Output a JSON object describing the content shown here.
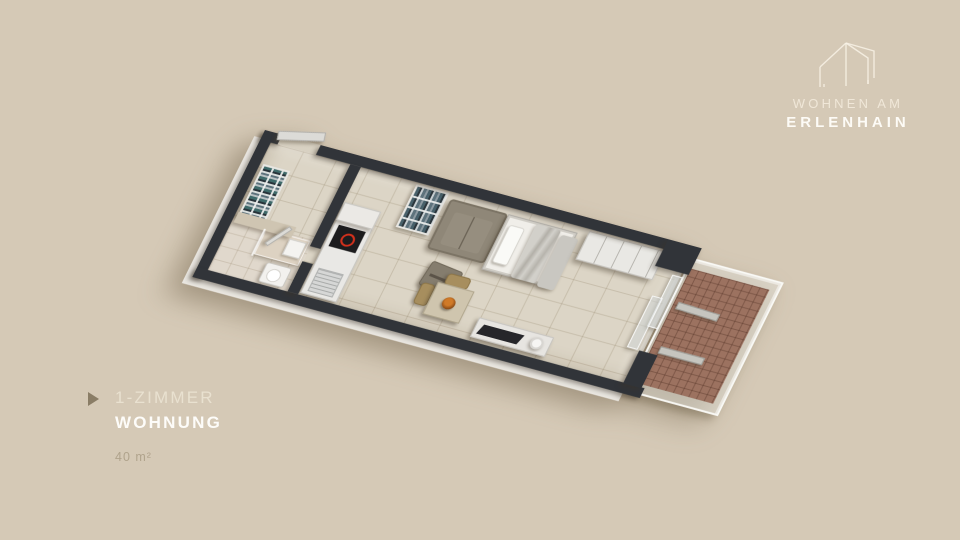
{
  "page": {
    "background_color": "#d5c9b6"
  },
  "brand": {
    "logo_icon": "house-outline-icon",
    "line1": "WOHNEN AM",
    "line2": "ERLENHAIN",
    "text_color": "#fdfbf6"
  },
  "caption": {
    "marker_icon": "play-arrow-icon",
    "line1": "1-ZIMMER",
    "line2": "WOHNUNG",
    "area": "40 m²",
    "line1_color": "#e9e1d0",
    "line2_color": "#fdfcf9",
    "area_color": "#b0a38c",
    "marker_color": "#8a7d66"
  },
  "floorplan": {
    "view": "3d-cutaway-top",
    "colors": {
      "wall": "#313439",
      "floor_tile": "#dcd5c6",
      "bathroom_floor": "#e0d8cc",
      "balcony_tile": "#9c7260",
      "cooktop": "#1c1c1e",
      "cooktop_ring": "#d2301c",
      "sofa": "#8f8778",
      "wood": "#cfc5ae",
      "white_furniture": "#ebe9e5"
    }
  }
}
